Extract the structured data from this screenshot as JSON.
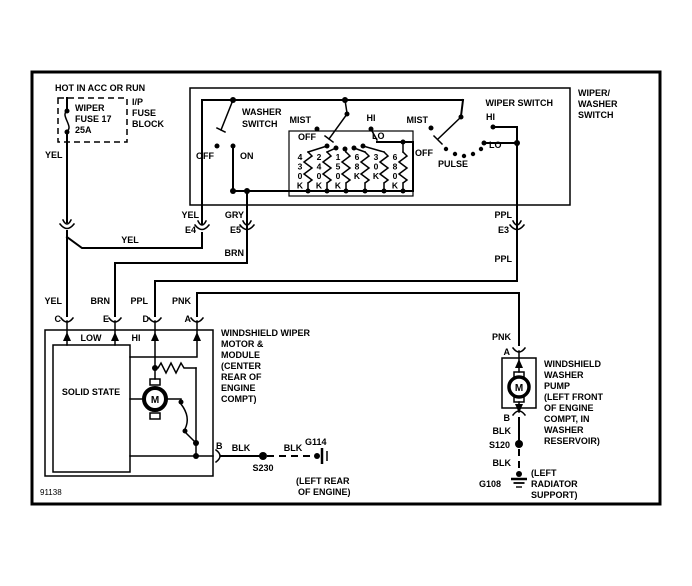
{
  "footer_id": "91138",
  "power": {
    "hot": "HOT IN ACC OR RUN",
    "fuse_line1": "WIPER",
    "fuse_line2": "FUSE 17",
    "fuse_line3": "25A",
    "block_line1": "I/P",
    "block_line2": "FUSE",
    "block_line3": "BLOCK"
  },
  "wire_colors": {
    "yel": "YEL",
    "gry": "GRY",
    "brn": "BRN",
    "ppl": "PPL",
    "pnk": "PNK",
    "blk": "BLK"
  },
  "connectors": {
    "e3": "E3",
    "e4": "E4",
    "e5": "E5"
  },
  "switch": {
    "title": "WIPER SWITCH",
    "outside1": "WIPER/",
    "outside2": "WASHER",
    "outside3": "SWITCH",
    "washer1": "WASHER",
    "washer2": "SWITCH",
    "off": "OFF",
    "on": "ON",
    "mist": "MIST",
    "hi": "HI",
    "lo": "LO",
    "pulse": "PULSE",
    "resistors": [
      "430K",
      "240K",
      "150K",
      "68K",
      "30K",
      "680K"
    ]
  },
  "module": {
    "c": "C",
    "e": "E",
    "d": "D",
    "a": "A",
    "b": "B",
    "low": "LOW",
    "hi": "HI",
    "solid_state": "SOLID STATE",
    "motor": "M",
    "name": [
      "WINDSHIELD WIPER",
      "MOTOR &",
      "MODULE",
      "(CENTER",
      "REAR OF",
      "ENGINE",
      "COMPT)"
    ]
  },
  "pump": {
    "a": "A",
    "b": "B",
    "motor": "M",
    "name": [
      "WINDSHIELD",
      "WASHER",
      "PUMP",
      "(LEFT FRONT",
      "OF ENGINE",
      "COMPT, IN",
      "WASHER",
      "RESERVOIR)"
    ]
  },
  "grounds": {
    "g114": "G114",
    "g114_loc1": "(LEFT REAR",
    "g114_loc2": "OF ENGINE)",
    "g108": "G108",
    "g108_loc1": "(LEFT",
    "g108_loc2": "RADIATOR",
    "g108_loc3": "SUPPORT)"
  },
  "splices": {
    "s230": "S230",
    "s120": "S120"
  }
}
